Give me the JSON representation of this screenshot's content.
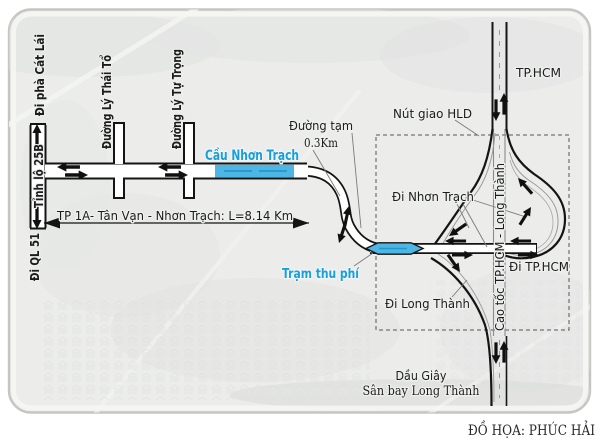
{
  "title_context": "road-interchange-infographic",
  "colors": {
    "label_blue": "#1a9fd9",
    "bridge_fill": "#4db6e4",
    "bridge_dash": "#2596c8",
    "road_casing": "#141414",
    "road_fill": "#ffffff",
    "background": "#ecedeb"
  },
  "labels": {
    "di_pha_cat_lai": "Đi phà Cát Lái",
    "tinh_lo_25b": "Tỉnh lộ 25B",
    "di_ql51": "Đi QL 51",
    "duong_ly_thai_to": "Đường Lý Thái Tổ",
    "duong_ly_tu_trong": "Đường Lý Tự Trọng",
    "cau_nhon_trach": "Cầu Nhơn Trạch",
    "duong_tam": "Đường tạm",
    "duong_tam_length": "0.3Km",
    "nut_giao_hld": "Nút giao HLD",
    "tphcm_top": "TP.HCM",
    "di_nhon_trach": "Đi Nhơn Trạch",
    "cao_toc": "Cao tốc TP.HCM - Long Thành",
    "di_tphcm": "Đi TP.HCM",
    "di_long_thanh": "Đi Long Thành",
    "tram_thu_phi": "Trạm thu phí",
    "route_dimension": "TP 1A- Tân Vạn - Nhơn Trạch: L=8.14 Km",
    "dau_giay": "Dầu Giây",
    "san_bay_long_thanh": "Sân bay Long Thành",
    "credit": "ĐỒ HỌA: PHÚC HẢI"
  }
}
